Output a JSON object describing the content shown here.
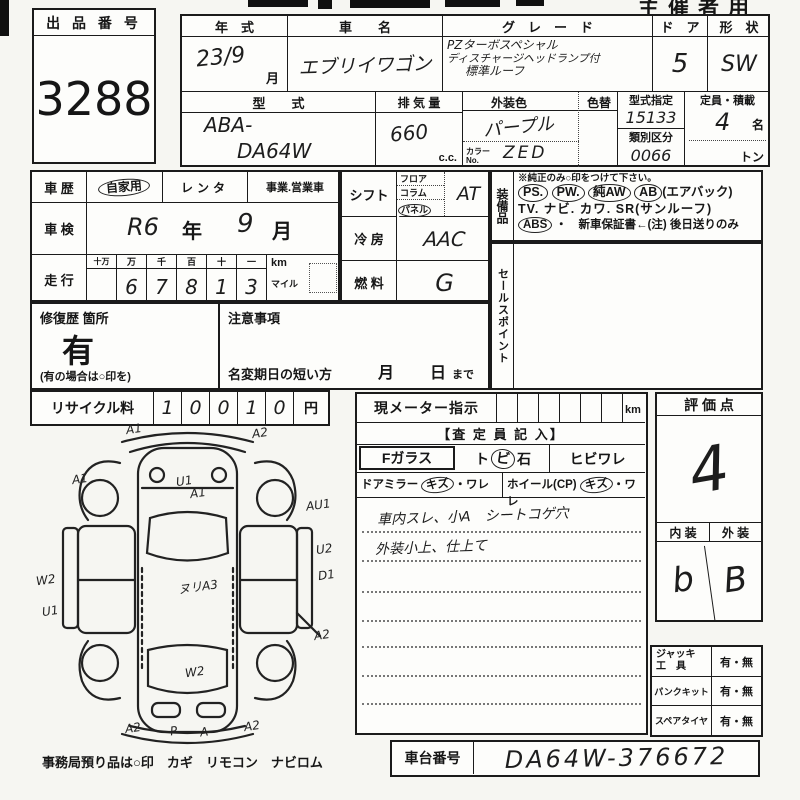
{
  "meta": {
    "organizer": "主催者用"
  },
  "lot": {
    "label": "出 品 番 号",
    "number": "3288"
  },
  "top": {
    "year": {
      "label": "年　式",
      "value": "23/9",
      "unit": "月"
    },
    "name": {
      "label": "車　　名",
      "value": "エブリイワゴン"
    },
    "grade": {
      "label": "グ　レ　ー　ド",
      "line1": "PZターボスペシャル",
      "line2": "ディスチャージヘッドランプ付",
      "line3": "標準ルーフ"
    },
    "doors": {
      "label": "ド　ア",
      "value": "5"
    },
    "shape": {
      "label": "形　状",
      "value": "SW"
    },
    "model": {
      "label": "型　　式",
      "line1": "ABA-",
      "line2": "DA64W"
    },
    "displacement": {
      "label": "排 気 量",
      "value": "660",
      "unit": "c.c."
    },
    "color": {
      "label": "外装色",
      "change": "色替",
      "value": "パープル",
      "no_label": "カラーNo.",
      "no_value": "ZED"
    },
    "designation": {
      "label": "型式指定",
      "value": "15133",
      "label2": "類別区分",
      "value2": "0066"
    },
    "capacity": {
      "label": "定員・積載",
      "value": "4",
      "unit1": "名",
      "unit2": "トン"
    }
  },
  "history": {
    "label": "車 歴",
    "opt1": "自家用",
    "opt2": "レンタ",
    "opt3": "事業.営業車",
    "inspection": {
      "label": "車 検",
      "v1": "R6",
      "u1": "年",
      "v2": "9",
      "u2": "月"
    },
    "mileage": {
      "label": "走 行",
      "h1": "十万",
      "h2": "万",
      "h3": "千",
      "h4": "百",
      "h5": "十",
      "h6": "一",
      "d1": "",
      "d2": "6",
      "d3": "7",
      "d4": "8",
      "d5": "1",
      "d6": "3",
      "km": "km",
      "mile": "マイル"
    }
  },
  "controls": {
    "shift": {
      "label": "シフト",
      "opt1": "フロア",
      "opt2": "コラム",
      "opt3": "パネル",
      "value": "AT"
    },
    "ac": {
      "label": "冷 房",
      "value": "AAC"
    },
    "fuel": {
      "label": "燃 料",
      "value": "G"
    }
  },
  "equipment": {
    "label": "装備品",
    "note": "※純正のみ○印をつけて下さい。",
    "ps": "PS.",
    "pw": "PW.",
    "aw": "純AW",
    "ab": "AB",
    "ab_note": "(エアバック)",
    "tv": "TV.",
    "navi": "ナビ.",
    "kawa": "カワ.",
    "sr": "SR(サンルーフ)",
    "abs": "ABS",
    "warranty": "・　新車保証書←(注) 後日送りのみ"
  },
  "sales_point": {
    "label": "セールスポイント"
  },
  "repair": {
    "label": "修復歴 箇所",
    "value": "有",
    "note": "(有の場合は○印を)"
  },
  "caution": {
    "label": "注意事項",
    "rename": "名変期日の短い方",
    "month": "月",
    "day": "日",
    "made": "まで"
  },
  "recycle": {
    "label": "リサイクル料",
    "d1": "1",
    "d2": "0",
    "d3": "0",
    "d4": "1",
    "d5": "0",
    "unit": "円"
  },
  "diagram": {
    "note": "事務局預り品は○印　カギ　リモコン　ナビロム",
    "marks": [
      {
        "text": "A1"
      },
      {
        "text": "A2"
      },
      {
        "text": "A1"
      },
      {
        "text": "U1"
      },
      {
        "text": "A1"
      },
      {
        "text": "AU1"
      },
      {
        "text": "U2"
      },
      {
        "text": "D1"
      },
      {
        "text": "W2"
      },
      {
        "text": "U1"
      },
      {
        "text": "ヌリA3"
      },
      {
        "text": "A2"
      },
      {
        "text": "W2"
      },
      {
        "text": "A2"
      },
      {
        "text": "P"
      },
      {
        "text": "A"
      },
      {
        "text": "A2"
      }
    ]
  },
  "inspector": {
    "meter_label": "現メーター指示",
    "meter_unit": "km",
    "header": "【査 定 員 記 入】",
    "f_glass": "Fガラス",
    "stone1": "ト",
    "stone2": "ビ",
    "stone3": "石",
    "crack": "ヒビワレ",
    "mirror": "ドアミラー",
    "mirror_k": "キズ",
    "mirror_w": "・ワレ",
    "wheel": "ホイール(CP)",
    "wheel_k": "キズ",
    "wheel_w": "・ワレ",
    "note1": "車内スレ、小A　シートコゲ穴",
    "note2": "外装小上、仕上て"
  },
  "evaluation": {
    "label": "評 価 点",
    "score": "4",
    "interior_label": "内 装",
    "exterior_label": "外 装",
    "interior": "b",
    "exterior": "B"
  },
  "tools": {
    "jack1": "ジャッキ",
    "jack2": "工　具",
    "jack_v": "有・無",
    "punk": "パンクキット",
    "punk_v": "有・無",
    "spare": "スペアタイヤ",
    "spare_v": "有・無"
  },
  "chassis": {
    "label": "車台番号",
    "value": "DA64W-376672"
  }
}
